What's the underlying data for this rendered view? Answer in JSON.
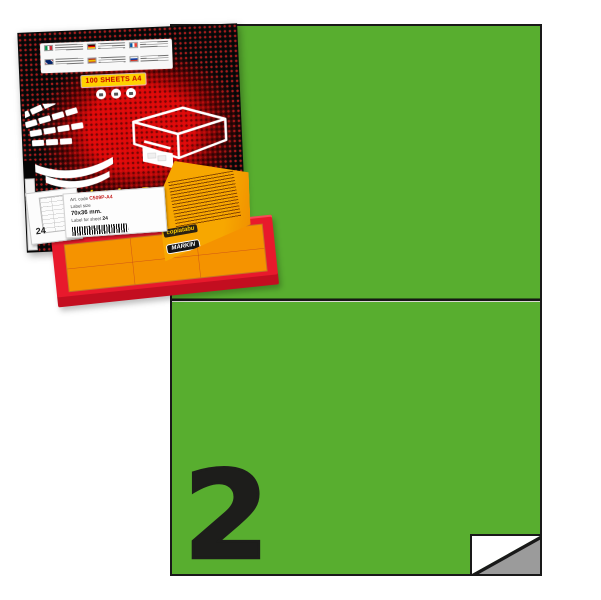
{
  "image_kind": "product-photo-of-adhesive-label-pack",
  "colors": {
    "sheet_green": "#58ae2f",
    "sheet_border": "#191919",
    "number_black": "#1d1d1b",
    "peel_backing_gray": "#9b9b9b",
    "box_red": "#e60a0a",
    "box_black": "#0a0a0a",
    "badge_yellow": "#ffd200",
    "flap_yellow": "#f7a700",
    "tray_red": "#e8192c",
    "orange_sheet": "#f59300"
  },
  "sheet": {
    "labels_per_sheet_number": "2"
  },
  "box": {
    "badge": "100 SHEETS A4",
    "brand_line": "copiatabu Premium",
    "brand": "MARKIN",
    "website": "www.markin.it",
    "side_panel_count": "24",
    "flap": {
      "brand_line": "copiatabu",
      "brand": "MARKIN"
    },
    "product_label": {
      "art_code_label": "Art. code",
      "art_code": "C509P-A4",
      "size_label": "Label size",
      "size_value": "70x36 mm.",
      "per_sheet_label": "Label for sheet",
      "per_sheet_value": "24"
    },
    "flags": [
      "italy",
      "germany",
      "france",
      "uk",
      "spain",
      "russia"
    ]
  }
}
